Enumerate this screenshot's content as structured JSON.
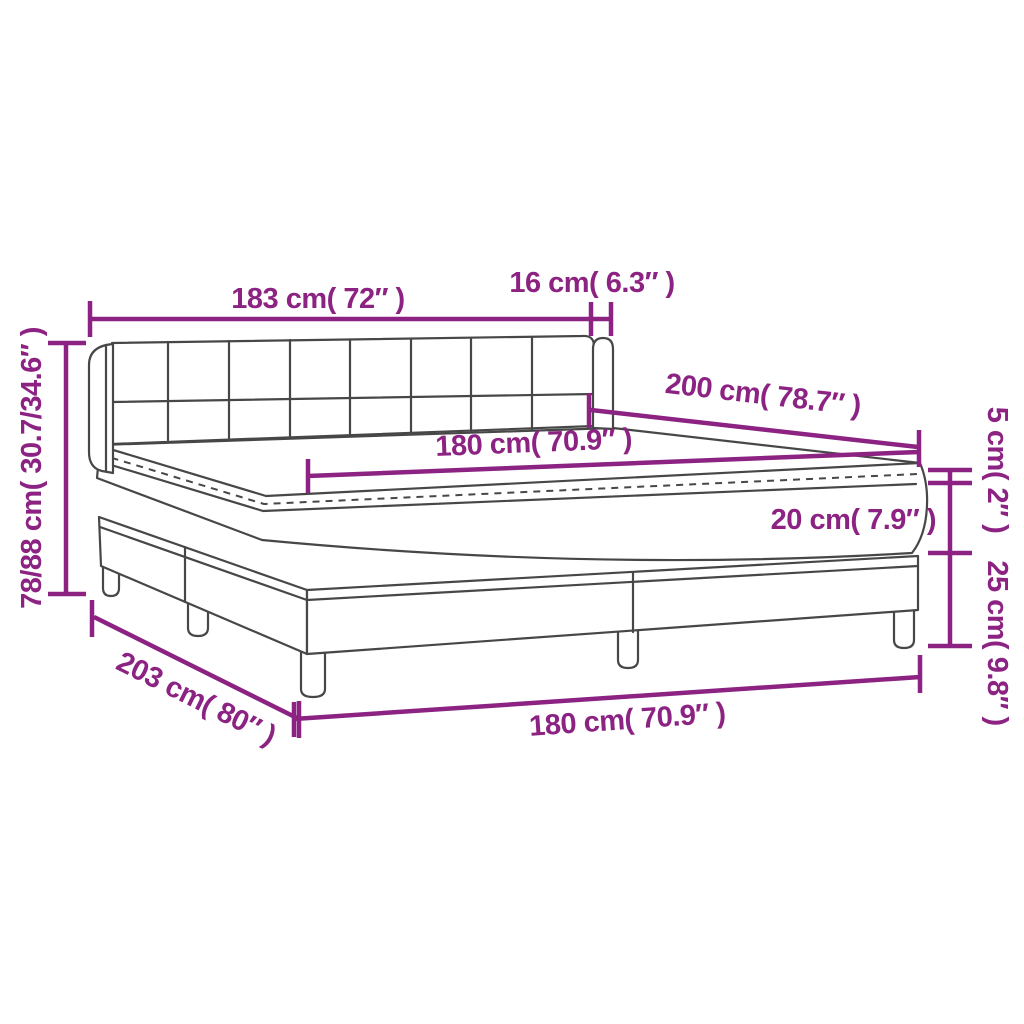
{
  "diagram": {
    "colors": {
      "annotation": "#8C2383",
      "line_art": "#474747",
      "background": "#FFFFFF"
    },
    "labels": {
      "headboard_width": "183 cm( 72″ )",
      "headboard_side_depth": "16 cm( 6.3″ )",
      "bed_length": "200 cm( 78.7″ )",
      "mattress_width": "180 cm( 70.9″ )",
      "overall_height_range": "78/88 cm( 30.7/34.6″ )",
      "overall_length": "203 cm( 80″ )",
      "base_width": "180 cm( 70.9″ )",
      "topper_thickness": "5 cm( 2″ )",
      "mattress_thickness": "20 cm( 7.9″ )",
      "base_height": "25 cm( 9.8″ )"
    }
  }
}
